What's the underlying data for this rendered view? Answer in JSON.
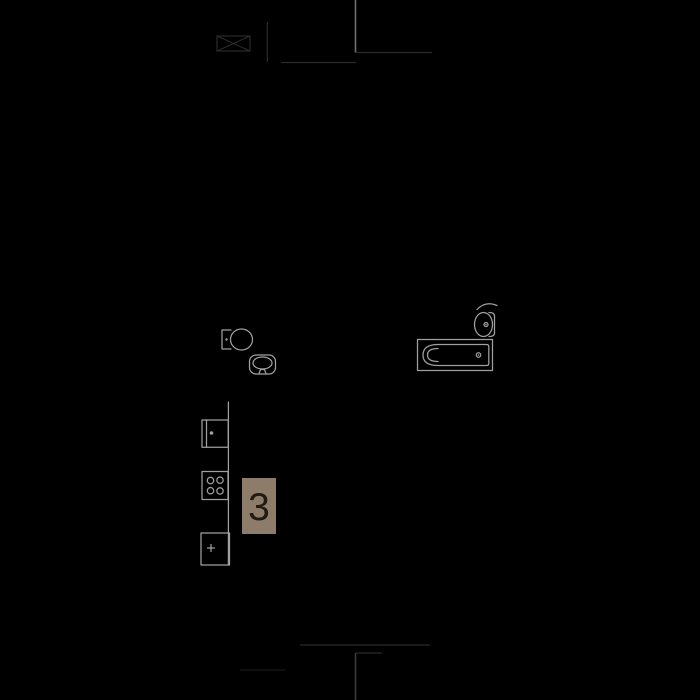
{
  "floorplan": {
    "background_color": "#000000",
    "fixture_line_color": "#a0a0a0",
    "wall_line_color": "#707070",
    "faint_line_color": "#2a2a2a",
    "room_badge": {
      "number": "3",
      "background_color": "#8e7c6a",
      "text_color": "#221b14"
    },
    "fixtures": [
      "toilet",
      "wash-basin",
      "bathroom-sink",
      "bathtub",
      "kitchen-counter",
      "kitchen-sink",
      "cooktop",
      "refrigerator"
    ]
  }
}
